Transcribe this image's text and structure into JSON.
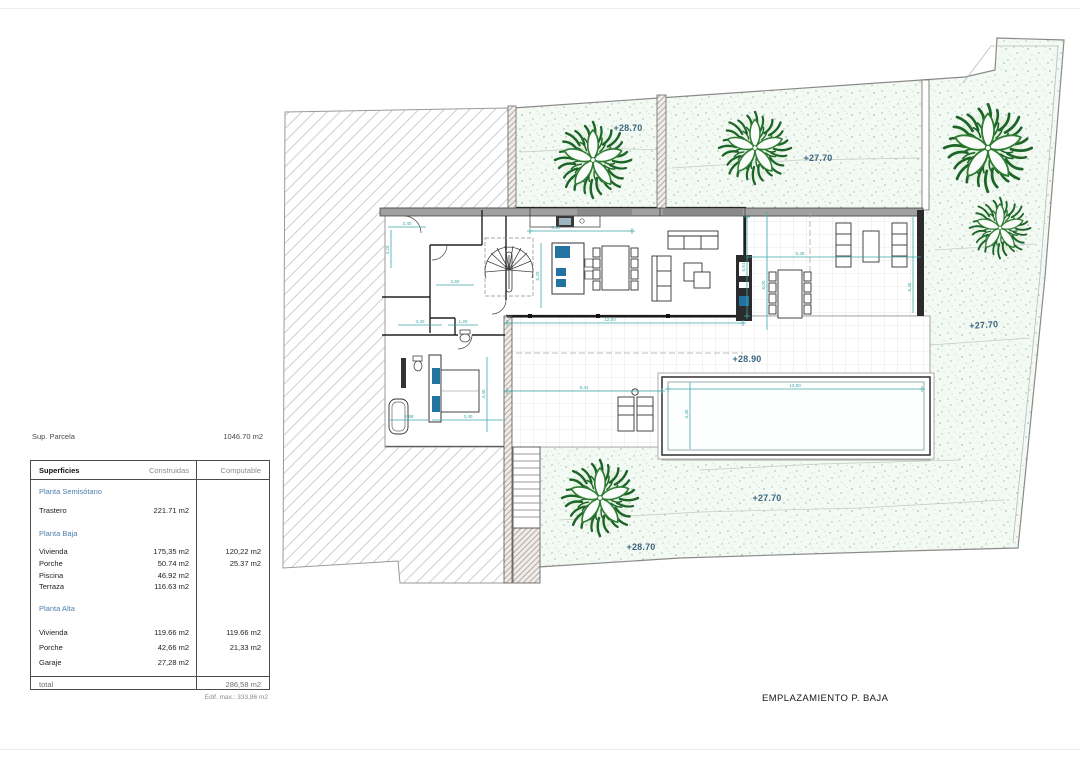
{
  "plan": {
    "title": "EMPLAZAMIENTO P. BAJA",
    "elevations": [
      {
        "name": "upper-garden",
        "text": "+28.70"
      },
      {
        "name": "upper-right-garden",
        "text": "+27.70"
      },
      {
        "name": "right-garden",
        "text": "+27.70"
      },
      {
        "name": "terrace",
        "text": "+28.90"
      },
      {
        "name": "lower-garden",
        "text": "+28.70"
      },
      {
        "name": "lower-right-garden",
        "text": "+27.70"
      }
    ],
    "dimensions": [
      {
        "text": "2,40"
      },
      {
        "text": "4,20"
      },
      {
        "text": "2,60"
      },
      {
        "text": "8,10"
      },
      {
        "text": "5,29"
      },
      {
        "text": "12,00"
      },
      {
        "text": "8,44"
      },
      {
        "text": "5,61"
      },
      {
        "text": "5,30"
      },
      {
        "text": "6,00"
      },
      {
        "text": "5,45"
      },
      {
        "text": "13,80"
      },
      {
        "text": "3,40"
      },
      {
        "text": "2,88"
      },
      {
        "text": "3,40"
      },
      {
        "text": "4,40"
      },
      {
        "text": "3,40"
      },
      {
        "text": "1,20"
      }
    ],
    "colors": {
      "dimension_teal": "#3fa8aa",
      "elevation_blue": "#3a657f",
      "tree_green": "#1d6428",
      "accent_blue": "#2272a2"
    }
  },
  "parcel_info": {
    "label": "Sup. Parcela",
    "value": "1046.70 m2",
    "edif_max": "Edif. max.: 333,86 m2"
  },
  "surfaces_table": {
    "headers": {
      "col1": "Superficies",
      "col2": "Construidas",
      "col3": "Computable"
    },
    "sections": [
      {
        "title": "Planta Semisótano",
        "rows": [
          {
            "label": "Trastero",
            "construida": "221.71 m2",
            "computable": ""
          }
        ]
      },
      {
        "title": "Planta Baja",
        "rows": [
          {
            "label": "Vivienda",
            "construida": "175,35 m2",
            "computable": "120,22 m2"
          },
          {
            "label": "Porche",
            "construida": "50.74 m2",
            "computable": "25.37 m2"
          },
          {
            "label": "Piscina",
            "construida": "46.92 m2",
            "computable": ""
          },
          {
            "label": "Terraza",
            "construida": "116.63 m2",
            "computable": ""
          }
        ]
      },
      {
        "title": "Planta Alta",
        "rows": [
          {
            "label": "Vivienda",
            "construida": "119.66 m2",
            "computable": "119.66 m2"
          },
          {
            "label": "Porche",
            "construida": "42,66 m2",
            "computable": "21,33 m2"
          },
          {
            "label": "Garaje",
            "construida": "27,28 m2",
            "computable": ""
          }
        ]
      }
    ],
    "total": {
      "label": "total",
      "value": "286,58 m2"
    }
  }
}
